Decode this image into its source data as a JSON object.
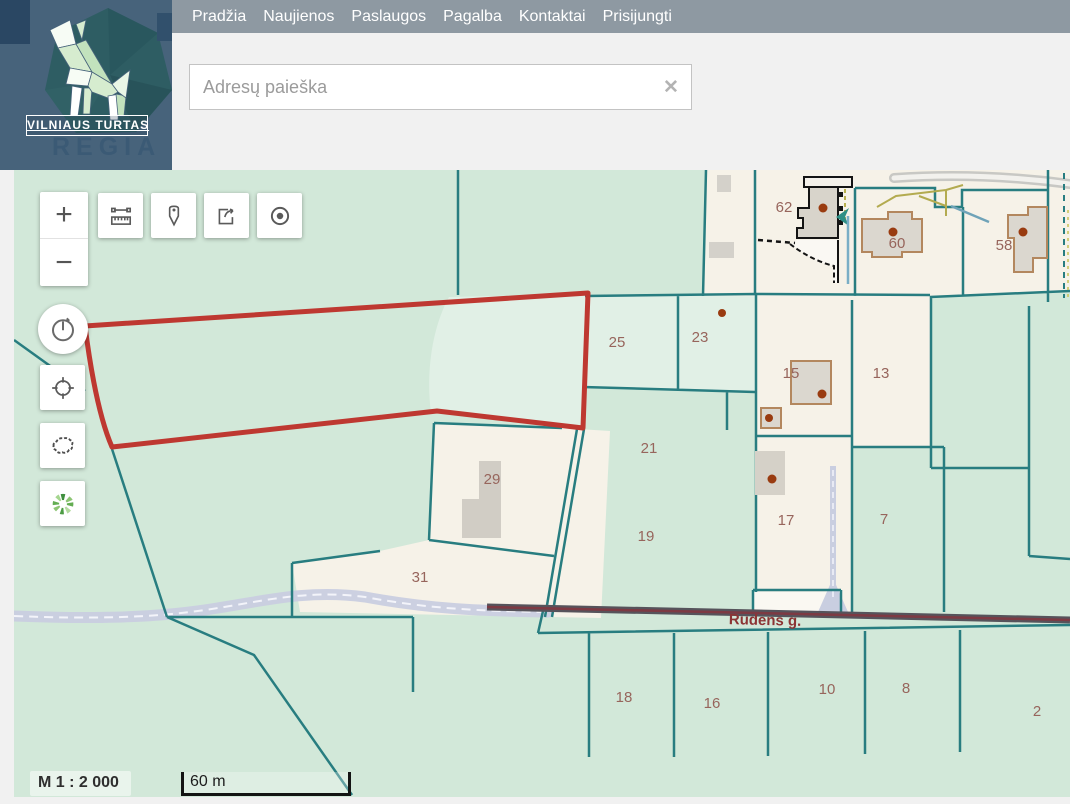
{
  "header": {
    "brand": {
      "name": "VILNIAUS TURTAS",
      "watermark": "REGIA"
    },
    "nav": {
      "items": [
        {
          "label": "Pradžia"
        },
        {
          "label": "Naujienos"
        },
        {
          "label": "Paslaugos"
        },
        {
          "label": "Pagalba"
        },
        {
          "label": "Kontaktai"
        },
        {
          "label": "Prisijungti"
        }
      ]
    },
    "search": {
      "placeholder": "Adresų paieška",
      "clear_icon": "✕"
    }
  },
  "map": {
    "street_label": "Rudens g.",
    "parcel_labels": [
      {
        "text": "62",
        "x": 770,
        "y": 42
      },
      {
        "text": "60",
        "x": 883,
        "y": 78
      },
      {
        "text": "58",
        "x": 990,
        "y": 80
      },
      {
        "text": "25",
        "x": 603,
        "y": 177
      },
      {
        "text": "23",
        "x": 686,
        "y": 172
      },
      {
        "text": "15",
        "x": 777,
        "y": 208
      },
      {
        "text": "13",
        "x": 867,
        "y": 208
      },
      {
        "text": "21",
        "x": 635,
        "y": 283
      },
      {
        "text": "19",
        "x": 632,
        "y": 371
      },
      {
        "text": "29",
        "x": 478,
        "y": 314
      },
      {
        "text": "31",
        "x": 406,
        "y": 412
      },
      {
        "text": "17",
        "x": 772,
        "y": 355
      },
      {
        "text": "7",
        "x": 870,
        "y": 354
      },
      {
        "text": "18",
        "x": 610,
        "y": 532
      },
      {
        "text": "16",
        "x": 698,
        "y": 538
      },
      {
        "text": "10",
        "x": 813,
        "y": 524
      },
      {
        "text": "8",
        "x": 892,
        "y": 523
      },
      {
        "text": "2",
        "x": 1023,
        "y": 546
      }
    ],
    "controls": {
      "zoom_in": "+",
      "zoom_out": "−",
      "tools": [
        {
          "name": "measure"
        },
        {
          "name": "add-marker"
        },
        {
          "name": "export"
        },
        {
          "name": "locate"
        },
        {
          "name": "history"
        },
        {
          "name": "geolocate"
        },
        {
          "name": "lithuania-extent"
        },
        {
          "name": "basemap-wheel"
        }
      ]
    },
    "scale": {
      "ratio": "M 1 : 2 000",
      "bar": "60 m"
    },
    "colors": {
      "background": "#d2e8d9",
      "parcel_light": "#e1f0e6",
      "parcel_beige": "#f6f2e8",
      "boundary": "#287d80",
      "selection": "#be3831",
      "labels": "#97655c",
      "water": "#c9cee0",
      "road": "#56535b"
    }
  }
}
